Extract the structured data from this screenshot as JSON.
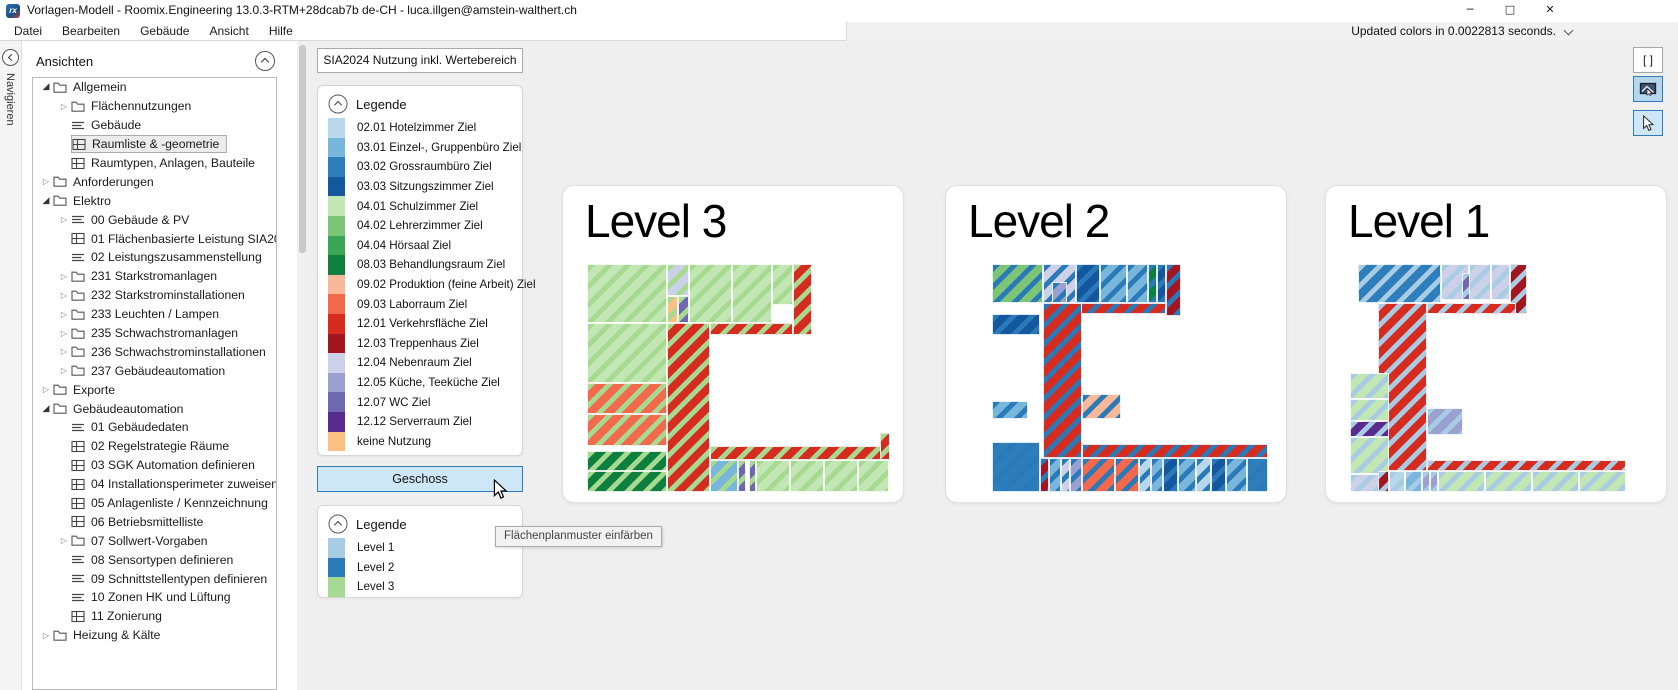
{
  "window": {
    "title": "Vorlagen-Modell - Roomix.Engineering 13.0.3-RTM+28dcab7b de-CH - luca.illgen@amstein-walthert.ch",
    "controls": {
      "minimize": "─",
      "maximize": "□",
      "close": "✕"
    }
  },
  "menu": {
    "items": [
      "Datei",
      "Bearbeiten",
      "Gebäude",
      "Ansicht",
      "Hilfe"
    ]
  },
  "status": {
    "text": "Updated colors in 0.0022813 seconds."
  },
  "navigator": {
    "vertical_label": "Navigieren",
    "panel_title": "Ansichten",
    "tree": [
      {
        "d": 0,
        "e": "exp",
        "i": "folder",
        "l": "Allgemein"
      },
      {
        "d": 1,
        "e": "col",
        "i": "folder",
        "l": "Flächennutzungen"
      },
      {
        "d": 1,
        "e": "none",
        "i": "list",
        "l": "Gebäude"
      },
      {
        "d": 1,
        "e": "none",
        "i": "grid",
        "l": "Raumliste & -geometrie",
        "sel": true
      },
      {
        "d": 1,
        "e": "none",
        "i": "grid",
        "l": "Raumtypen, Anlagen, Bauteile"
      },
      {
        "d": 0,
        "e": "col",
        "i": "folder",
        "l": "Anforderungen"
      },
      {
        "d": 0,
        "e": "exp",
        "i": "folder",
        "l": "Elektro"
      },
      {
        "d": 1,
        "e": "col",
        "i": "list",
        "l": "00 Gebäude & PV"
      },
      {
        "d": 1,
        "e": "none",
        "i": "grid",
        "l": "01 Flächenbasierte Leistung SIA2024"
      },
      {
        "d": 1,
        "e": "none",
        "i": "list",
        "l": "02 Leistungszusammenstellung"
      },
      {
        "d": 1,
        "e": "col",
        "i": "folder",
        "l": "231 Starkstromanlagen"
      },
      {
        "d": 1,
        "e": "col",
        "i": "folder",
        "l": "232 Starkstrominstallationen"
      },
      {
        "d": 1,
        "e": "col",
        "i": "folder",
        "l": "233 Leuchten / Lampen"
      },
      {
        "d": 1,
        "e": "col",
        "i": "folder",
        "l": "235 Schwachstromanlagen"
      },
      {
        "d": 1,
        "e": "col",
        "i": "folder",
        "l": "236 Schwachstrominstallationen"
      },
      {
        "d": 1,
        "e": "col",
        "i": "folder",
        "l": "237 Gebäudeautomation"
      },
      {
        "d": 0,
        "e": "col",
        "i": "folder",
        "l": "Exporte"
      },
      {
        "d": 0,
        "e": "exp",
        "i": "folder",
        "l": "Gebäudeautomation"
      },
      {
        "d": 1,
        "e": "none",
        "i": "list",
        "l": "01 Gebäudedaten"
      },
      {
        "d": 1,
        "e": "none",
        "i": "grid",
        "l": "02 Regelstrategie Räume"
      },
      {
        "d": 1,
        "e": "none",
        "i": "grid",
        "l": "03 SGK Automation definieren"
      },
      {
        "d": 1,
        "e": "none",
        "i": "grid",
        "l": "04 Installationsperimeter zuweisen"
      },
      {
        "d": 1,
        "e": "none",
        "i": "grid",
        "l": "05 Anlagenliste / Kennzeichnung"
      },
      {
        "d": 1,
        "e": "none",
        "i": "grid",
        "l": "06 Betriebsmittelliste"
      },
      {
        "d": 1,
        "e": "col",
        "i": "folder",
        "l": "07 Sollwert-Vorgaben"
      },
      {
        "d": 1,
        "e": "none",
        "i": "list",
        "l": "08 Sensortypen definieren"
      },
      {
        "d": 1,
        "e": "none",
        "i": "list",
        "l": "09 Schnittstellentypen definieren"
      },
      {
        "d": 1,
        "e": "none",
        "i": "list",
        "l": "10 Zonen HK und Lüftung"
      },
      {
        "d": 1,
        "e": "none",
        "i": "grid",
        "l": "11 Zonierung"
      },
      {
        "d": 0,
        "e": "col",
        "i": "folder",
        "l": "Heizung & Kälte"
      }
    ]
  },
  "legend_panel": {
    "view_button": "SIA2024 Nutzung inkl. Wertebereich",
    "usage_legend": {
      "title": "Legende",
      "items": [
        {
          "code": "02.01",
          "label": "02.01 Hotelzimmer Ziel"
        },
        {
          "code": "03.01",
          "label": "03.01 Einzel-, Gruppenbüro Ziel"
        },
        {
          "code": "03.02",
          "label": "03.02 Grossraumbüro Ziel"
        },
        {
          "code": "03.03",
          "label": "03.03 Sitzungszimmer Ziel"
        },
        {
          "code": "04.01",
          "label": "04.01 Schulzimmer Ziel"
        },
        {
          "code": "04.02",
          "label": "04.02 Lehrerzimmer Ziel"
        },
        {
          "code": "04.04",
          "label": "04.04 Hörsaal Ziel"
        },
        {
          "code": "08.03",
          "label": "08.03 Behandlungsraum Ziel"
        },
        {
          "code": "09.02",
          "label": "09.02 Produktion (feine Arbeit) Ziel"
        },
        {
          "code": "09.03",
          "label": "09.03 Laborraum Ziel"
        },
        {
          "code": "12.01",
          "label": "12.01 Verkehrsfläche Ziel"
        },
        {
          "code": "12.03",
          "label": "12.03 Treppenhaus Ziel"
        },
        {
          "code": "12.04",
          "label": "12.04 Nebenraum Ziel"
        },
        {
          "code": "12.05",
          "label": "12.05 Küche, Teeküche Ziel"
        },
        {
          "code": "12.07",
          "label": "12.07 WC Ziel"
        },
        {
          "code": "12.12",
          "label": "12.12 Serverraum Ziel"
        },
        {
          "code": "keine",
          "label": "keine Nutzung"
        }
      ]
    },
    "geschoss_button": "Geschoss",
    "tooltip": "Flächenplanmuster einfärben",
    "level_legend": {
      "title": "Legende",
      "items": [
        {
          "label": "Level 1",
          "color": "#a8cce4"
        },
        {
          "label": "Level 2",
          "color": "#2a79b8"
        },
        {
          "label": "Level 3",
          "color": "#a6da90"
        }
      ]
    }
  },
  "colors": {
    "02.01": "#b9d7ea",
    "03.01": "#79b6dc",
    "03.02": "#2e7ebc",
    "03.03": "#13589f",
    "04.01": "#c3e7b4",
    "04.02": "#7cc576",
    "04.04": "#3aa554",
    "08.03": "#0f7f3f",
    "09.02": "#f8b89a",
    "09.03": "#f2694b",
    "12.01": "#d62b1f",
    "12.03": "#a4161f",
    "12.04": "#cdd1e8",
    "12.05": "#9aa0d0",
    "12.07": "#6f68b0",
    "12.12": "#592b8c",
    "keine": "#fcc083"
  },
  "level_colors": {
    "L1": "#a8cce4",
    "L2": "#2a79b8",
    "L3": "#a6da90"
  },
  "toolbar": {
    "brackets": "[ ]"
  },
  "plans": [
    {
      "title": "Level 3",
      "level": "L3",
      "rooms": [
        [
          0,
          0,
          26,
          26,
          "04.01"
        ],
        [
          0,
          26,
          26,
          26,
          "04.01"
        ],
        [
          0,
          52,
          26,
          14,
          "09.03"
        ],
        [
          0,
          66,
          26,
          14,
          "09.03"
        ],
        [
          0,
          82,
          26,
          9,
          "08.03"
        ],
        [
          0,
          91,
          26,
          9,
          "08.03"
        ],
        [
          26,
          0,
          7,
          14,
          "12.04"
        ],
        [
          26,
          14,
          3.5,
          12,
          "keine"
        ],
        [
          29.5,
          14,
          3.5,
          12,
          "12.07"
        ],
        [
          33,
          0,
          14,
          26,
          "04.01"
        ],
        [
          47,
          0,
          13,
          26,
          "04.01"
        ],
        [
          60,
          0,
          7,
          18,
          "04.01"
        ],
        [
          67,
          0,
          6,
          31,
          "12.01"
        ],
        [
          26,
          26,
          14,
          74,
          "12.01"
        ],
        [
          40,
          26,
          27,
          5,
          "12.01"
        ],
        [
          40,
          80,
          58,
          6,
          "12.01"
        ],
        [
          95,
          74,
          3.5,
          12,
          "12.01"
        ],
        [
          40,
          86,
          9,
          14,
          "03.01"
        ],
        [
          49,
          86,
          2.5,
          14,
          "12.07"
        ],
        [
          52.5,
          86,
          2.5,
          14,
          "12.07"
        ],
        [
          55,
          86,
          11,
          14,
          "04.01"
        ],
        [
          66,
          86,
          11,
          14,
          "04.01"
        ],
        [
          77,
          86,
          11,
          14,
          "04.01"
        ],
        [
          88,
          86,
          10,
          14,
          "04.01"
        ]
      ]
    },
    {
      "title": "Level 2",
      "level": "L2",
      "rooms": [
        [
          8,
          0,
          17,
          17,
          "04.02"
        ],
        [
          25,
          0,
          11,
          17,
          "12.04"
        ],
        [
          28,
          8,
          5,
          9,
          "12.05"
        ],
        [
          36,
          0,
          8,
          17,
          "03.03"
        ],
        [
          44,
          0,
          9,
          17,
          "03.01"
        ],
        [
          53,
          0,
          7,
          17,
          "03.01"
        ],
        [
          60,
          0,
          3,
          17,
          "08.03"
        ],
        [
          63,
          0,
          3,
          17,
          "03.03"
        ],
        [
          66,
          0,
          5,
          23,
          "12.03"
        ],
        [
          36,
          17,
          30,
          5,
          "12.01"
        ],
        [
          8,
          22,
          16,
          9,
          "03.03"
        ],
        [
          25,
          17,
          13,
          68,
          "12.01"
        ],
        [
          8,
          60,
          12,
          8,
          "03.01"
        ],
        [
          38,
          57,
          13,
          11,
          "09.02"
        ],
        [
          8,
          78,
          16,
          22,
          "03.02"
        ],
        [
          38,
          79,
          62,
          6,
          "12.01"
        ],
        [
          24,
          85,
          3,
          15,
          "12.03"
        ],
        [
          27,
          85,
          4,
          15,
          "03.01"
        ],
        [
          31,
          85,
          3,
          15,
          "12.04"
        ],
        [
          34,
          85,
          4,
          15,
          "12.05"
        ],
        [
          38,
          85,
          11,
          15,
          "09.03"
        ],
        [
          49,
          85,
          8,
          15,
          "09.03"
        ],
        [
          57,
          85,
          4,
          15,
          "02.01"
        ],
        [
          61,
          85,
          4,
          15,
          "03.01"
        ],
        [
          65,
          85,
          5,
          15,
          "03.03"
        ],
        [
          70,
          85,
          6,
          15,
          "03.01"
        ],
        [
          76,
          85,
          5,
          15,
          "02.01"
        ],
        [
          81,
          85,
          5,
          15,
          "03.03"
        ],
        [
          86,
          85,
          7,
          15,
          "03.01"
        ],
        [
          93,
          85,
          7,
          15,
          "03.02"
        ]
      ]
    },
    {
      "title": "Level 1",
      "level": "L1",
      "rooms": [
        [
          3,
          0,
          30,
          17,
          "03.02"
        ],
        [
          33,
          0,
          10,
          16,
          "12.04"
        ],
        [
          43,
          0,
          8,
          16,
          "12.04"
        ],
        [
          51,
          0,
          7,
          16,
          "12.04"
        ],
        [
          40.5,
          4,
          3,
          12,
          "12.07"
        ],
        [
          58,
          0,
          6,
          22,
          "12.03"
        ],
        [
          10,
          17,
          18,
          74,
          "12.01"
        ],
        [
          28,
          17,
          32,
          5,
          "12.01"
        ],
        [
          0,
          48,
          14,
          11,
          "04.01"
        ],
        [
          0,
          59,
          14,
          10,
          "04.01"
        ],
        [
          0,
          69,
          14,
          7,
          "12.12"
        ],
        [
          0,
          76,
          14,
          16,
          "04.01"
        ],
        [
          0,
          92,
          14,
          8,
          "12.04"
        ],
        [
          28,
          63,
          13,
          12,
          "12.05"
        ],
        [
          28,
          86,
          72,
          5,
          "12.01"
        ],
        [
          10,
          91,
          4,
          9,
          "12.03"
        ],
        [
          14,
          91,
          6,
          9,
          "02.01"
        ],
        [
          20,
          91,
          6,
          9,
          "03.01"
        ],
        [
          26,
          91,
          3,
          9,
          "12.05"
        ],
        [
          29,
          91,
          3,
          9,
          "12.05"
        ],
        [
          32,
          91,
          17,
          9,
          "04.01"
        ],
        [
          49,
          91,
          17,
          9,
          "04.01"
        ],
        [
          66,
          91,
          17,
          9,
          "04.01"
        ],
        [
          83,
          91,
          17,
          9,
          "04.01"
        ]
      ]
    }
  ]
}
